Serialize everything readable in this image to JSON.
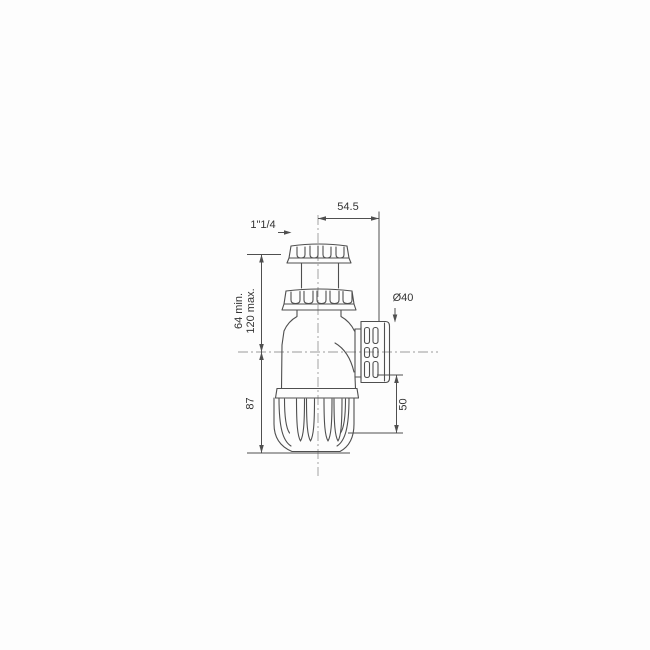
{
  "diagram": {
    "name": "bottle-trap-siphon-technical-drawing",
    "colors": {
      "background": "#fdfdfd",
      "outline": "#4f4f4f",
      "dimension": "#4f4f4f",
      "centerline": "#9b9b9b",
      "text": "#333333"
    },
    "labels": {
      "top_width": "54.5",
      "inlet_thread": "1\"1/4",
      "inlet_min": "64 min.",
      "inlet_max": "120 max.",
      "body_height": "87",
      "outlet_diameter": "Ø40",
      "outlet_drop": "50"
    }
  }
}
